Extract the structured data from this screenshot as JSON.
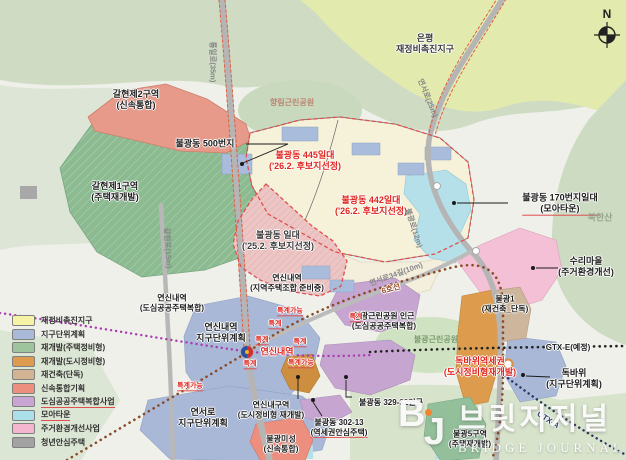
{
  "legend": {
    "items": [
      {
        "label": "재정비촉진지구",
        "color": "#f6f2a6",
        "underline": false
      },
      {
        "label": "지구단위계획",
        "color": "#a9b9d8",
        "underline": false
      },
      {
        "label": "재개발(주택정비형)",
        "color": "#9dc49d",
        "underline": false
      },
      {
        "label": "재개발(도시정비형)",
        "color": "#dd9b4d",
        "underline": false
      },
      {
        "label": "재건축(단독)",
        "color": "#d2b394",
        "underline": false
      },
      {
        "label": "신속통합기획",
        "color": "#ec8f7e",
        "underline": false
      },
      {
        "label": "도심공공주택복합사업",
        "color": "#c8a5d2",
        "underline": true
      },
      {
        "label": "모아타운",
        "color": "#abdfe9",
        "underline": true
      },
      {
        "label": "주거환경개선사업",
        "color": "#f3b6ce",
        "underline": false
      },
      {
        "label": "청년안심주택",
        "color": "#a2a2a2",
        "underline": false
      }
    ]
  },
  "labels": [
    {
      "id": "eunpyeong-district",
      "cls": "lab-dark",
      "x": 425,
      "y": 44,
      "lines": [
        "은평",
        "재정비촉진지구"
      ]
    },
    {
      "id": "hyanglim-park",
      "cls": "lab-park",
      "x": 292,
      "y": 103,
      "lines": [
        "향림근린공원"
      ]
    },
    {
      "id": "galhyeon2-zone",
      "cls": "lab-black",
      "x": 136,
      "y": 100,
      "lines": [
        "갈현제2구역",
        "(신속통합)"
      ]
    },
    {
      "id": "galhyeon1-zone",
      "cls": "lab-black",
      "x": 115,
      "y": 192,
      "lines": [
        "갈현제1구역",
        "(주택재개발)"
      ]
    },
    {
      "id": "bulgwang-500",
      "cls": "lab-black",
      "x": 205,
      "y": 144,
      "lines": [
        "불광동 500번지"
      ]
    },
    {
      "id": "bulgwang-445",
      "cls": "lab-red",
      "x": 305,
      "y": 161,
      "lines": [
        "불광동 445일대",
        "('26.2. 후보지선정)"
      ]
    },
    {
      "id": "bulgwang-442",
      "cls": "lab-red",
      "x": 371,
      "y": 206,
      "lines": [
        "불광동 442일대",
        "('26.2. 후보지선정)"
      ]
    },
    {
      "id": "bulgwang-ildae",
      "cls": "lab-dark",
      "x": 278,
      "y": 241,
      "lines": [
        "불광동 일대",
        "('25.2. 후보지선정)"
      ]
    },
    {
      "id": "bulgwang-170",
      "cls": "lab-black",
      "x": 560,
      "y": 204,
      "lines": [
        "불광동 170번지일대",
        "(모아타운)"
      ],
      "u": 1
    },
    {
      "id": "bukhansan",
      "cls": "lab-mountain",
      "x": 600,
      "y": 218,
      "lines": [
        "북한산"
      ]
    },
    {
      "id": "suri-village",
      "cls": "lab-black",
      "x": 586,
      "y": 267,
      "lines": [
        "수리마을",
        "(주거환경개선)"
      ]
    },
    {
      "id": "yeonsinnae-jujo",
      "cls": "lab-black-sm",
      "x": 287,
      "y": 283,
      "lines": [
        "연신내역",
        "(지역주택조합 준비중)"
      ]
    },
    {
      "id": "yeonsinnae-dosim",
      "cls": "lab-black-sm",
      "x": 172,
      "y": 303,
      "lines": [
        "연신내역",
        "(도심공공주택복합)"
      ]
    },
    {
      "id": "yeonsinnae-district-plan",
      "cls": "lab-black",
      "x": 221,
      "y": 333,
      "lines": [
        "연신내역",
        "지구단위계획"
      ]
    },
    {
      "id": "yeonsinnae-station",
      "cls": "lab-red",
      "x": 277,
      "y": 352,
      "lines": [
        "연신내역"
      ]
    },
    {
      "id": "bulgwang-park-near",
      "cls": "lab-black-sm",
      "x": 384,
      "y": 321,
      "lines": [
        "불광근린공원 인근",
        "(도심공공주택복합)"
      ]
    },
    {
      "id": "bulgwang-park",
      "cls": "lab-park-green",
      "x": 436,
      "y": 340,
      "lines": [
        "불광근린공원"
      ]
    },
    {
      "id": "bulgwang1-zone",
      "cls": "lab-black-sm",
      "x": 505,
      "y": 304,
      "lines": [
        "불광1",
        "(재건축_단독)"
      ]
    },
    {
      "id": "dokbawi-station-area",
      "cls": "lab-red",
      "x": 480,
      "y": 367,
      "lines": [
        "독바위역세권",
        "(도시정비형재개발)"
      ]
    },
    {
      "id": "dokbawi-plan",
      "cls": "lab-black",
      "x": 574,
      "y": 379,
      "lines": [
        "독바위",
        "(지구단위계획)"
      ]
    },
    {
      "id": "gtx-e-line",
      "cls": "lab-black-sm",
      "x": 568,
      "y": 348,
      "lines": [
        "GTX-E(예정)"
      ]
    },
    {
      "id": "gtx-a-line",
      "cls": "lab-navy",
      "x": 548,
      "y": 420,
      "rot": 33,
      "lines": [
        "GTX-A"
      ]
    },
    {
      "id": "line6",
      "cls": "lab-line6",
      "x": 391,
      "y": 289,
      "rot": -16,
      "lines": [
        "6호선"
      ]
    },
    {
      "id": "yeonseo-plan",
      "cls": "lab-black",
      "x": 203,
      "y": 418,
      "lines": [
        "연서로",
        "지구단위계획"
      ]
    },
    {
      "id": "yeonsinnae-guyeok",
      "cls": "lab-black-sm",
      "x": 271,
      "y": 410,
      "lines": [
        "연신내구역",
        "(도시정비형 재개발)"
      ]
    },
    {
      "id": "bulgwang-329",
      "cls": "lab-black-sm",
      "x": 391,
      "y": 403,
      "lines": [
        "불광동 329-32인근"
      ]
    },
    {
      "id": "bulgwang-302",
      "cls": "lab-black-sm",
      "x": 339,
      "y": 428,
      "lines": [
        "불광동 302-13",
        "(역세권안심주택)"
      ],
      "u": 1
    },
    {
      "id": "bulgwang-miseong",
      "cls": "lab-black-sm",
      "x": 281,
      "y": 444,
      "lines": [
        "불광미성",
        "(신속통합)"
      ]
    },
    {
      "id": "bulgwang5-zone",
      "cls": "lab-black-sm",
      "x": 470,
      "y": 439,
      "lines": [
        "불광5구역",
        "(주택재개발)"
      ]
    },
    {
      "id": "road-tongilro",
      "cls": "lab-gray-road",
      "x": 213,
      "y": 62,
      "rot": 90,
      "lines": [
        "통일로(35m)"
      ]
    },
    {
      "id": "road-yeonseoro25",
      "cls": "lab-gray-road",
      "x": 428,
      "y": 98,
      "rot": 68,
      "lines": [
        "연서로(25m)"
      ]
    },
    {
      "id": "road-galhyeonro",
      "cls": "lab-gray-road",
      "x": 168,
      "y": 248,
      "rot": 87,
      "lines": [
        "갈현로(15m)"
      ]
    },
    {
      "id": "road-bulgwangro12",
      "cls": "lab-gray-road",
      "x": 414,
      "y": 228,
      "rot": 72,
      "lines": [
        "불광로(12m)"
      ]
    },
    {
      "id": "road-yeonseoro34",
      "cls": "lab-gray-road",
      "x": 396,
      "y": 274,
      "rot": -20,
      "lines": [
        "연서로34길(10m)"
      ]
    },
    {
      "id": "teukgye-1",
      "cls": "lab-red-sm",
      "x": 290,
      "y": 312,
      "lines": [
        "특계가능"
      ],
      "u": 0
    },
    {
      "id": "teukgye-2",
      "cls": "lab-red-sm",
      "x": 275,
      "y": 325,
      "lines": [
        "특계"
      ],
      "u": 0
    },
    {
      "id": "teukgye-3",
      "cls": "lab-red-sm",
      "x": 262,
      "y": 341,
      "lines": [
        "특계"
      ],
      "u": 0
    },
    {
      "id": "teukgye-4",
      "cls": "lab-red-sm",
      "x": 300,
      "y": 343,
      "lines": [
        "특계"
      ],
      "u": 0
    },
    {
      "id": "teukgye-5",
      "cls": "lab-red-sm",
      "x": 356,
      "y": 318,
      "lines": [
        "특계"
      ],
      "u": 0
    },
    {
      "id": "teukgye-6",
      "cls": "lab-red-sm",
      "x": 250,
      "y": 365,
      "lines": [
        "특계"
      ],
      "u": 0
    },
    {
      "id": "teukgye-7",
      "cls": "lab-red-sm",
      "x": 301,
      "y": 364,
      "lines": [
        "특계가능"
      ],
      "u": 0
    },
    {
      "id": "teukgye-8",
      "cls": "lab-red-sm",
      "x": 190,
      "y": 387,
      "lines": [
        "특계가능"
      ],
      "u": 0
    }
  ],
  "watermark": {
    "logo_b": "B",
    "logo_j": "J",
    "title": "브릿지저널",
    "subtitle": "BRIDGE JOURNAL"
  },
  "compass": {
    "label": "N"
  }
}
